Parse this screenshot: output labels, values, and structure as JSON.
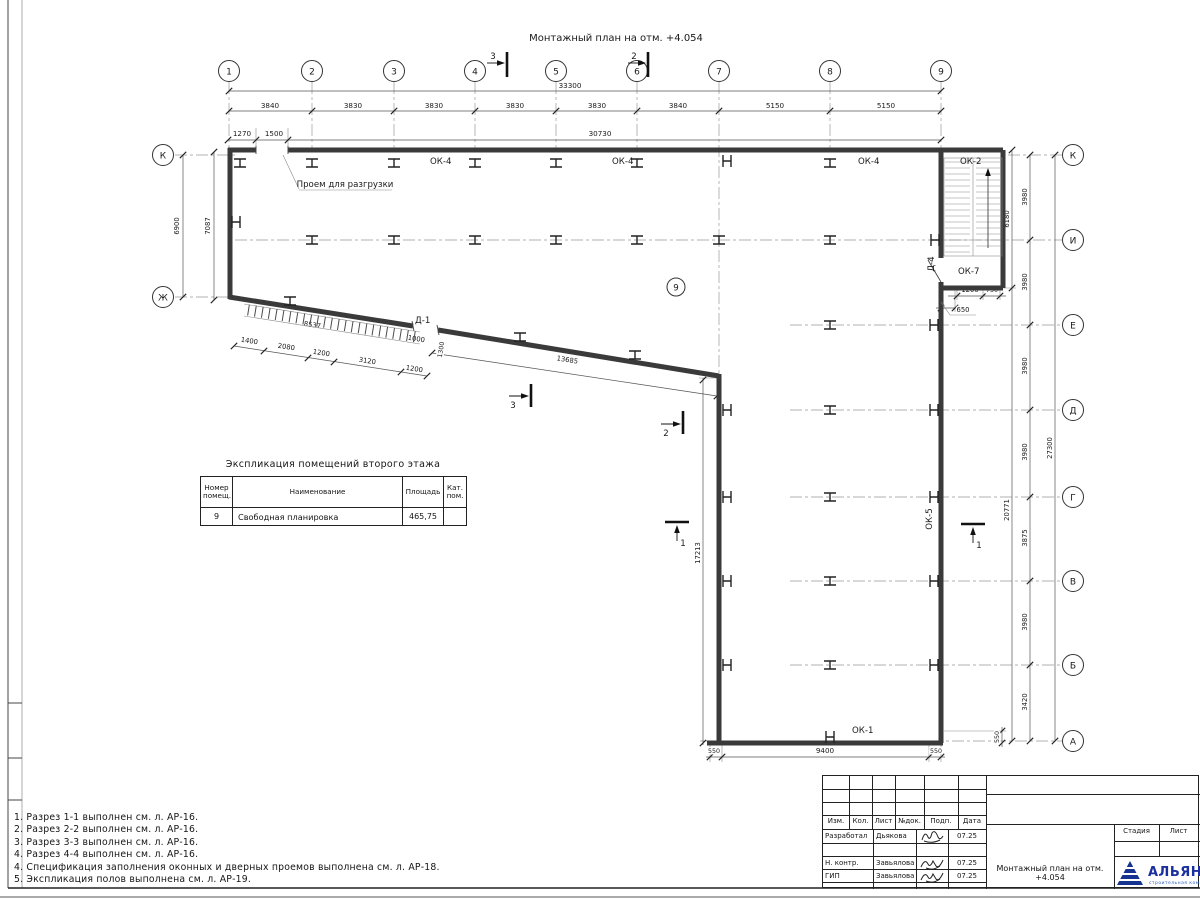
{
  "drawing": {
    "title": "Монтажный план на отм. +4.054",
    "axes": {
      "top": [
        "1",
        "2",
        "3",
        "4",
        "5",
        "6",
        "7",
        "8",
        "9"
      ],
      "right": [
        "К",
        "И",
        "Е",
        "Д",
        "Г",
        "В",
        "Б",
        "А"
      ],
      "left": [
        "К",
        "Ж"
      ]
    },
    "dims": {
      "total_top": "33300",
      "top_spans": [
        "3840",
        "3830",
        "3830",
        "3830",
        "3830",
        "3840",
        "5150",
        "5150"
      ],
      "top_sub": [
        "1270",
        "1500",
        "30730"
      ],
      "left_outer": "6900",
      "left_inner": "7087",
      "right_spans": [
        "3980",
        "3980",
        "3980",
        "3980",
        "3875",
        "3980",
        "3420"
      ],
      "right_total": "27300",
      "stair_height": "6180",
      "right_lower": "20771",
      "right_offset": "550",
      "stair_bottom": [
        "1200",
        "750",
        "650"
      ],
      "ramp_total": "8537",
      "ramp_spans": [
        "1400",
        "2080",
        "1200",
        "3120",
        "1200"
      ],
      "door_width": "1000",
      "door_offset": "1300",
      "diag_wall": "13685",
      "inner_wall": "17213",
      "bottom": [
        "550",
        "9400",
        "550"
      ]
    },
    "marks": {
      "ok4": "ОК-4",
      "ok2": "ОК-2",
      "ok7": "ОК-7",
      "ok5": "ОК-5",
      "ok1": "ОК-1",
      "d1": "Д-1",
      "d4": "Д-4"
    },
    "opening_label": "Проем для разгрузки",
    "room_tag": "9",
    "sections": {
      "s1": "1",
      "s2": "2",
      "s3": "3"
    }
  },
  "table": {
    "title": "Экспликация помещений второго этажа",
    "headers": {
      "num": "Номер помещ.",
      "name": "Наименование",
      "area": "Площадь",
      "cat": "Кат. пом."
    },
    "row": {
      "num": "9",
      "name": "Свободная планировка",
      "area": "465,75",
      "cat": ""
    }
  },
  "notes": [
    "1. Разрез 1-1 выполнен см. л. АР-16.",
    "2. Разрез 2-2 выполнен см. л. АР-16.",
    "3. Разрез 3-3 выполнен см. л. АР-16.",
    "4. Разрез 4-4 выполнен см. л. АР-16.",
    "4. Спецификация заполнения оконных и дверных проемов выполнена см. л. АР-18.",
    "5. Экспликация полов выполнена см. л. АР-19."
  ],
  "stamp": {
    "cols": {
      "izm": "Изм.",
      "kol": "Кол.",
      "list": "Лист",
      "ndok": "№док.",
      "podp": "Подп.",
      "data": "Дата"
    },
    "rows": [
      {
        "role": "Разработал",
        "name": "Дьякова",
        "date": "07.25"
      },
      {
        "role": "Н. контр.",
        "name": "Завьялова",
        "date": "07.25"
      },
      {
        "role": "ГИП",
        "name": "Завьялова",
        "date": "07.25"
      }
    ],
    "doc_title": "Монтажный план на отм. +4.054",
    "right": {
      "stage": "Стадия",
      "sheet": "Лист",
      "sheets": "Листов"
    },
    "logo": {
      "name": "АЛЬЯНС",
      "sub": "строительная компания",
      "blue": "#1b2f9e",
      "light_blue": "#2f62c4"
    }
  }
}
